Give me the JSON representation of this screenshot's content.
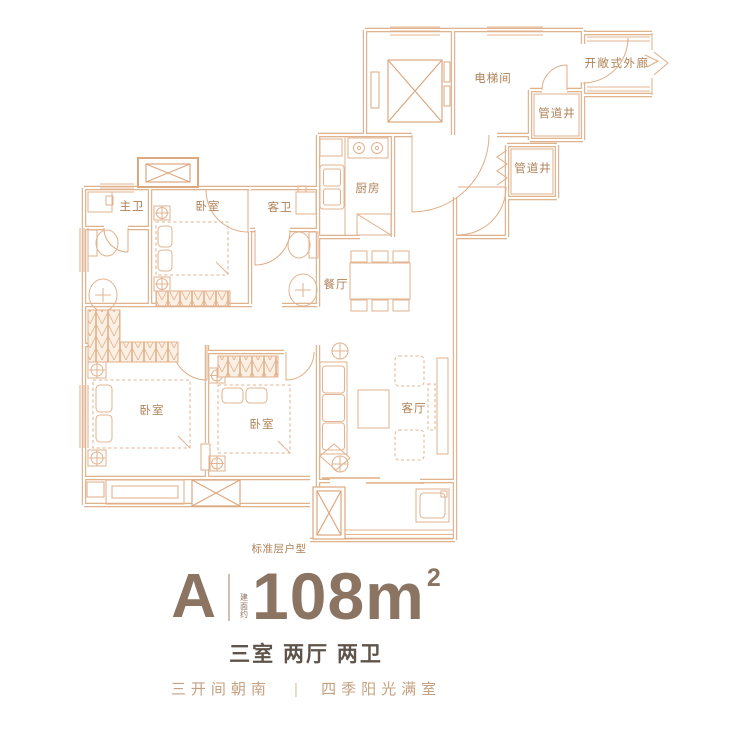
{
  "plan": {
    "rooms": {
      "master_bath": "主卫",
      "bedroom_north": "卧室",
      "guest_bath": "客卫",
      "kitchen": "厨房",
      "dining": "餐厅",
      "elevator_hall": "电梯间",
      "open_corridor": "开敞式外廊",
      "pipe_shaft_1": "管道井",
      "pipe_shaft_2": "管道井",
      "bedroom_west": "卧室",
      "bedroom_middle": "卧室",
      "living": "客厅"
    },
    "note": "标准层户型"
  },
  "title": {
    "unit": "A",
    "area_prefix": "建面约",
    "area": "108",
    "area_unit": "m",
    "area_sup": "2",
    "layout": "三室 两厅 两卫",
    "tagline_left": "三开间朝南",
    "tagline_divider": "|",
    "tagline_right": "四季阳光满室"
  },
  "colors": {
    "wall_line": "#DCA87F",
    "furniture_line": "#E3B491",
    "plan_text": "#AE8156",
    "title_text": "#8C7463",
    "subtitle_text": "#5E544B",
    "tagline_text": "#C6A181"
  }
}
